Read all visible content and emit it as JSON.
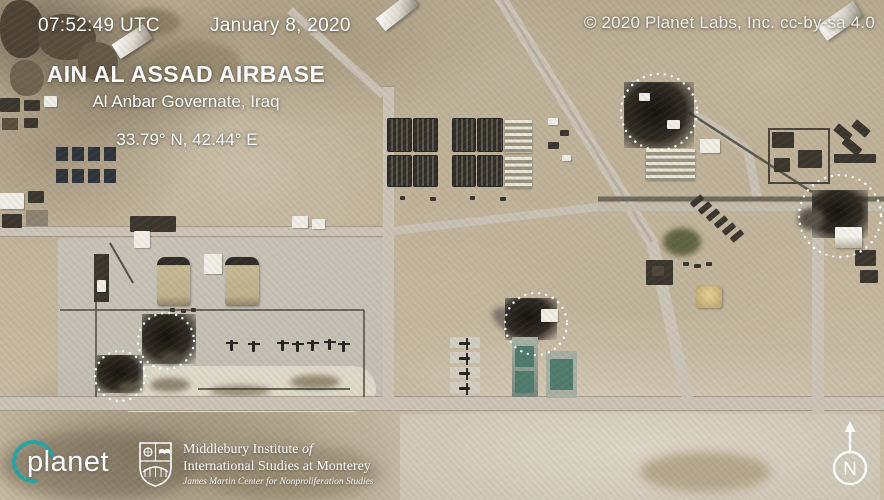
{
  "header": {
    "timestamp_utc": "07:52:49 UTC",
    "date": "January 8, 2020",
    "credit": "© 2020 Planet Labs, Inc. cc-by-sa 4.0"
  },
  "location": {
    "title": "AIN AL ASSAD AIRBASE",
    "subtitle": "Al Anbar Governate, Iraq",
    "coordinates": "33.79° N, 42.44° E"
  },
  "annotations": {
    "impact_markers": [
      {
        "x": 659,
        "y": 112,
        "r": 38
      },
      {
        "x": 840,
        "y": 216,
        "r": 41
      },
      {
        "x": 536,
        "y": 324,
        "r": 31
      },
      {
        "x": 166,
        "y": 341,
        "r": 28
      },
      {
        "x": 120,
        "y": 376,
        "r": 25
      }
    ],
    "marker_color": "#ffffff"
  },
  "footer": {
    "planet_logo_text": "planet",
    "institute_line1": "Middlebury Institute",
    "institute_line1_italic": "of",
    "institute_line2": "International Studies at Monterey",
    "institute_line3": "James Martin Center for Nonproliferation Studies",
    "compass_label": "N"
  },
  "colors": {
    "planet_teal": "#26a6a2",
    "overlay_text": "#ffffff"
  }
}
